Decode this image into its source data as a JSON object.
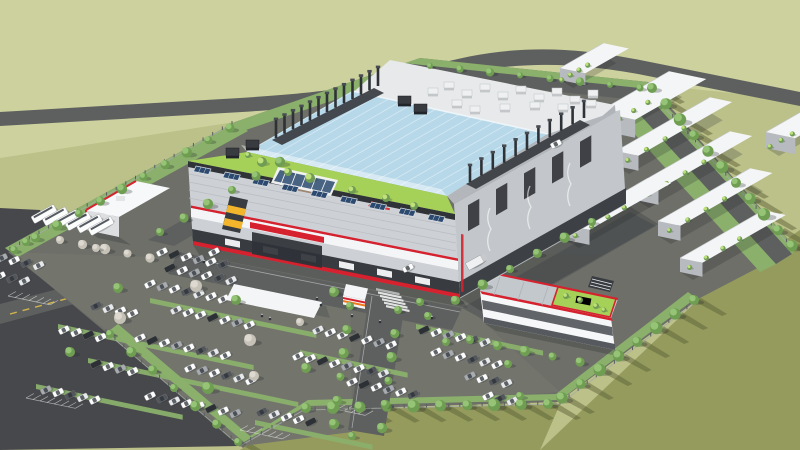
{
  "meta": {
    "description": "Aerial 3D architectural rendering of an industrial campus: a large fab building with light-blue glass roof, rooftop garden with solar canopy, exhaust stack rows, red-accented white facades and a small red brand logo; auxiliary building with red-trimmed roof garden, bus depot, white warehouse rows, gatehouse with crosswalk, tree-lined perimeter roads, large car parks and olive-green fields crossed by a highway."
  },
  "palette": {
    "field_light": "#cdd19d",
    "field_mid": "#bcc089",
    "field_dark": "#959b5d",
    "field_shadow": "#5d6437",
    "outer_lot": "#47484b",
    "road": "#5e605f",
    "road_light": "#6c6e69",
    "campus_ground": "#6d6f68",
    "parking": "#73756d",
    "green_strip": "#8ab06b",
    "green_dark": "#6f9c55",
    "lawn": "#a6d159",
    "lawn_light": "#bfe07a",
    "glass": "#b7d8e8",
    "glass_light": "#ddeef7",
    "white": "#f4f5f6",
    "off_white": "#e7e9ea",
    "facade": "#cdd0d4",
    "facade_mid": "#c3c7cb",
    "facade_dark": "#afb3b7",
    "graphite": "#383b40",
    "dark_band": "#2f3237",
    "accent_red": "#d6212e",
    "accent_orange": "#f07818",
    "accent_yellow": "#f2b52b",
    "solar_blue": "#2c4a70",
    "solar_frame": "#d8dde2",
    "pool_blue": "#3f8fd2",
    "tree_green": "#6f9e52",
    "tree_green_light": "#96c477",
    "tree_pale": "#c6c2b8",
    "tree_pale_light": "#ddd8d0",
    "marking_white": "#eceded",
    "marking_yellow": "#e5c34a",
    "shadow_color": "#23262b"
  },
  "scene": {
    "stack_rows": [
      {
        "x1": 276,
        "y1": 138,
        "x2": 378,
        "y2": 86,
        "n": 13,
        "h": 18
      },
      {
        "x1": 470,
        "y1": 182,
        "x2": 584,
        "y2": 118,
        "n": 11,
        "h": 16
      }
    ],
    "rooftop_units": [
      [
        428,
        88,
        0
      ],
      [
        444,
        82,
        0
      ],
      [
        462,
        90,
        0
      ],
      [
        480,
        84,
        0
      ],
      [
        498,
        92,
        0
      ],
      [
        516,
        86,
        0
      ],
      [
        534,
        94,
        0
      ],
      [
        552,
        88,
        0
      ],
      [
        570,
        96,
        0
      ],
      [
        588,
        90,
        0
      ],
      [
        452,
        100,
        0
      ],
      [
        470,
        106,
        0
      ],
      [
        500,
        104,
        0
      ],
      [
        530,
        102,
        0
      ],
      [
        558,
        104,
        0
      ],
      [
        586,
        100,
        0
      ],
      [
        398,
        96,
        1
      ],
      [
        414,
        104,
        1
      ],
      [
        246,
        140,
        1
      ],
      [
        226,
        148,
        1
      ]
    ],
    "solar_parapet": {
      "x1": 196,
      "y1": 166,
      "x2": 430,
      "y2": 214,
      "n": 9
    },
    "warehouses": [
      {
        "x": 598,
        "y": 130,
        "L": 82,
        "W": 38,
        "h": 18
      },
      {
        "x": 616,
        "y": 166,
        "L": 108,
        "W": 23,
        "h": 15
      },
      {
        "x": 636,
        "y": 200,
        "L": 108,
        "W": 23,
        "h": 15
      },
      {
        "x": 658,
        "y": 236,
        "L": 106,
        "W": 23,
        "h": 15
      },
      {
        "x": 680,
        "y": 272,
        "L": 96,
        "W": 23,
        "h": 14
      },
      {
        "x": 566,
        "y": 240,
        "L": 94,
        "W": 24,
        "h": 15
      },
      {
        "x": 550,
        "y": 208,
        "L": 64,
        "W": 18,
        "h": 12
      },
      {
        "x": 560,
        "y": 80,
        "L": 50,
        "W": 26,
        "h": 12
      },
      {
        "x": 766,
        "y": 148,
        "L": 64,
        "W": 30,
        "h": 16
      }
    ],
    "tree_rows": [
      {
        "x1": 14,
        "y1": 250,
        "x2": 230,
        "y2": 128,
        "n": 11,
        "r": 4,
        "type": "green"
      },
      {
        "x1": 430,
        "y1": 66,
        "x2": 640,
        "y2": 88,
        "n": 8,
        "r": 3,
        "type": "green"
      },
      {
        "x1": 652,
        "y1": 88,
        "x2": 792,
        "y2": 246,
        "n": 11,
        "r": 5,
        "type": "field"
      },
      {
        "x1": 694,
        "y1": 300,
        "x2": 562,
        "y2": 398,
        "n": 8,
        "r": 5,
        "type": "field"
      },
      {
        "x1": 548,
        "y1": 404,
        "x2": 306,
        "y2": 408,
        "n": 10,
        "r": 5,
        "type": "field"
      },
      {
        "x1": 238,
        "y1": 442,
        "x2": 110,
        "y2": 334,
        "n": 7,
        "r": 4,
        "type": "field"
      },
      {
        "x1": 350,
        "y1": 306,
        "x2": 334,
        "y2": 424,
        "n": 6,
        "r": 4,
        "type": "green"
      },
      {
        "x1": 398,
        "y1": 310,
        "x2": 382,
        "y2": 428,
        "n": 6,
        "r": 4,
        "type": "green"
      },
      {
        "x1": 428,
        "y1": 316,
        "x2": 592,
        "y2": 222,
        "n": 7,
        "r": 4,
        "type": "green"
      },
      {
        "x1": 470,
        "y1": 340,
        "x2": 580,
        "y2": 362,
        "n": 5,
        "r": 4,
        "type": "green"
      },
      {
        "x1": 60,
        "y1": 240,
        "x2": 150,
        "y2": 258,
        "n": 5,
        "r": 4,
        "type": "pale"
      },
      {
        "x1": 160,
        "y1": 232,
        "x2": 280,
        "y2": 162,
        "n": 6,
        "r": 4,
        "type": "green"
      }
    ],
    "single_trees": [
      [
        196,
        286,
        6,
        "pale"
      ],
      [
        236,
        300,
        5,
        "green"
      ],
      [
        120,
        318,
        6,
        "pale"
      ],
      [
        70,
        352,
        5,
        "green"
      ],
      [
        250,
        340,
        6,
        "pale"
      ],
      [
        306,
        368,
        5,
        "green"
      ],
      [
        208,
        388,
        6,
        "green"
      ],
      [
        118,
        288,
        5,
        "green"
      ],
      [
        334,
        292,
        5,
        "green"
      ],
      [
        300,
        322,
        4,
        "pale"
      ],
      [
        420,
        302,
        4,
        "green"
      ],
      [
        520,
        396,
        4,
        "green"
      ],
      [
        26,
        242,
        4,
        "green"
      ],
      [
        254,
        376,
        5,
        "pale"
      ],
      [
        352,
        436,
        4,
        "green"
      ],
      [
        96,
        248,
        4,
        "pale"
      ],
      [
        446,
        342,
        4,
        "green"
      ],
      [
        508,
        364,
        4,
        "green"
      ]
    ],
    "garden_trees": [
      [
        262,
        162,
        5
      ],
      [
        288,
        172,
        4
      ],
      [
        310,
        178,
        5
      ],
      [
        352,
        190,
        4
      ],
      [
        386,
        198,
        4
      ],
      [
        414,
        206,
        4
      ],
      [
        248,
        155,
        3
      ]
    ],
    "aux_garden_trees": [
      [
        566,
        296,
        3
      ],
      [
        580,
        300,
        3
      ],
      [
        596,
        306,
        3
      ],
      [
        604,
        310,
        2.5
      ]
    ],
    "car_rows": [
      {
        "x": 162,
        "y": 252,
        "n": 6
      },
      {
        "x": 170,
        "y": 268,
        "n": 6
      },
      {
        "x": 150,
        "y": 284,
        "n": 7
      },
      {
        "x": 2,
        "y": 258,
        "n": 4
      },
      {
        "x": 0,
        "y": 276,
        "n": 3
      },
      {
        "x": 96,
        "y": 306,
        "n": 4
      },
      {
        "x": 176,
        "y": 310,
        "n": 7
      },
      {
        "x": 64,
        "y": 330,
        "n": 4
      },
      {
        "x": 140,
        "y": 338,
        "n": 8
      },
      {
        "x": 96,
        "y": 364,
        "n": 4
      },
      {
        "x": 190,
        "y": 368,
        "n": 6
      },
      {
        "x": 46,
        "y": 390,
        "n": 5
      },
      {
        "x": 150,
        "y": 396,
        "n": 8
      },
      {
        "x": 262,
        "y": 412,
        "n": 5
      },
      {
        "x": 318,
        "y": 330,
        "n": 7
      },
      {
        "x": 298,
        "y": 356,
        "n": 8
      },
      {
        "x": 352,
        "y": 382,
        "n": 6
      },
      {
        "x": 424,
        "y": 330,
        "n": 6
      },
      {
        "x": 436,
        "y": 352,
        "n": 6
      },
      {
        "x": 470,
        "y": 376,
        "n": 4
      },
      {
        "x": 488,
        "y": 396,
        "n": 3
      }
    ],
    "road_cars": [
      [
        408,
        268
      ],
      [
        214,
        252
      ],
      [
        556,
        144
      ]
    ],
    "truck": {
      "x": 476,
      "y": 262
    },
    "buses": {
      "x": 44,
      "y": 214,
      "n": 6
    },
    "stall_grids": [
      {
        "x": 8,
        "y": 296,
        "n": 6
      },
      {
        "x": 26,
        "y": 398,
        "n": 7
      },
      {
        "x": 240,
        "y": 430,
        "n": 6
      },
      {
        "x": 330,
        "y": 408,
        "n": 5
      }
    ],
    "green_strips": [
      {
        "x": 150,
        "y": 298,
        "L": 170
      },
      {
        "x": 58,
        "y": 324,
        "L": 200
      },
      {
        "x": 88,
        "y": 358,
        "L": 215
      },
      {
        "x": 36,
        "y": 384,
        "L": 150
      },
      {
        "x": 255,
        "y": 420,
        "L": 120
      },
      {
        "x": 416,
        "y": 324,
        "L": 130
      },
      {
        "x": 300,
        "y": 350,
        "L": 110
      }
    ],
    "fences": [
      [
        [
          10,
          250
        ],
        [
          232,
          124
        ]
      ],
      [
        [
          650,
          92
        ],
        [
          794,
          250
        ]
      ],
      [
        [
          696,
          302
        ],
        [
          560,
          404
        ],
        [
          304,
          410
        ],
        [
          240,
          446
        ],
        [
          106,
          332
        ]
      ]
    ],
    "crosswalk": {
      "x": 376,
      "y": 288,
      "n": 6
    },
    "figures": [
      [
        317,
        299
      ],
      [
        321,
        305
      ],
      [
        262,
        316
      ],
      [
        270,
        319
      ],
      [
        432,
        318
      ],
      [
        204,
        262
      ],
      [
        352,
        316
      ],
      [
        380,
        322
      ]
    ],
    "facade_doors": {
      "n": 6
    },
    "se_openings": {
      "n": 5
    },
    "glass_ridges": {
      "n": 17
    }
  }
}
